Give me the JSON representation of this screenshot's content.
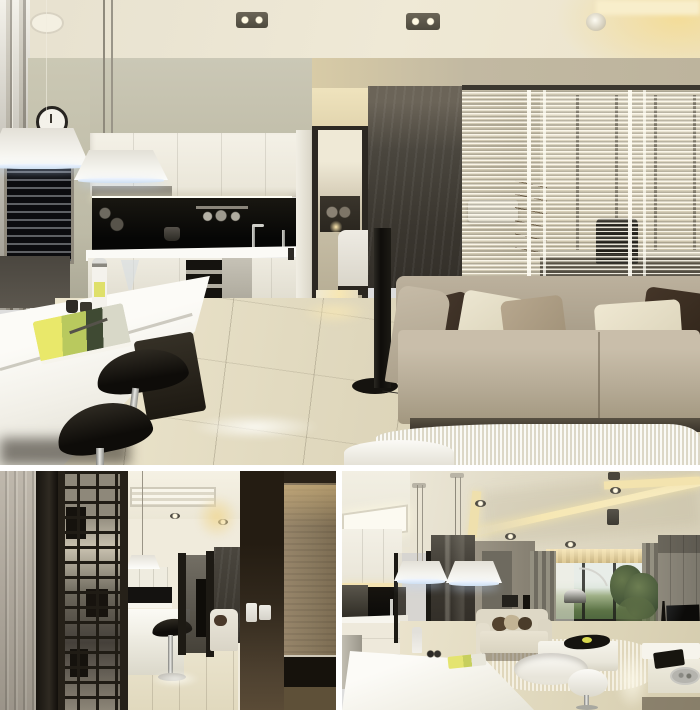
{
  "collage": {
    "title": "Modern apartment interior photo collage",
    "layout": "one large photo on top, two smaller photos below separated by white gutters",
    "photos": [
      {
        "id": "kitchen-living",
        "description": "Open-plan kitchen and living area: white island bar with black saddle stools, bottle, glass, cups and a magazine on the counter; white cabinets over a black backsplash with sink and chrome faucets; wall clock; two white pendant lamps; doorway to a bedroom; dark stone column; black tower speaker; greige fabric sofa with brown, cream and taupe cushions; white shag rug; glass partition with venetian blinds revealing a home office with black chair and dry branches; glossy beige tile floor."
      },
      {
        "id": "hallway-screen",
        "description": "Entry view: light wood plank wall, dark metal lattice screen looking through to the white island table with bar stools and black backsplash, dark brown sliding panel with white light switches, and a warm wood cabinet with a black shelf niche."
      },
      {
        "id": "living-room-wide",
        "description": "Wide living room view: white kitchen island with pendant cone lamps, cream sofa with brown pillows, chrome arc floor lamp, gray curtains and lit valance around a window with green trees, potted plant, gray media wall with flat TV, white low cabinet with tablet and chrome tray, white oval tables, cove-lit tray ceiling with recessed spots."
      }
    ]
  },
  "palette": {
    "gap-white": "#ffffff",
    "ceiling-cream": "#eae4d2",
    "ceiling-warm": "#f3e1ae",
    "wall-sage": "#c6c3af",
    "wall-tan": "#c2b9a2",
    "cabinet-white": "#f2efe5",
    "backsplash-black": "#0d0c0a",
    "counter-white": "#fbfaf6",
    "island-white": "#f8f7f2",
    "floor-beige": "#ded7c0",
    "window-dark": "#26272a",
    "stool-black": "#16130e",
    "chrome": "#b9bab6",
    "stone-dark": "#45413a",
    "office-base": "#ded6bf",
    "chair-black": "#201e19",
    "sofa-greige": "#b5aa96",
    "pillow-brown": "#3f332a",
    "pillow-cream": "#e8e2cd",
    "pillow-greige": "#b0a08a",
    "rug-white": "#edeadb",
    "speaker-black": "#17140f",
    "wood-panel": "#aba295",
    "door-brown": "#30271c",
    "switch-white": "#eceae3",
    "wood-cabinet": "#8e7c61",
    "ceiling-c": "#e3ddca",
    "cove-gold": "#f4e3ab",
    "curtain-gray": "#8c887c",
    "sky": "#e7ece7",
    "trees-green": "#5c7346",
    "plant-green": "#4a593a",
    "pot-black": "#26221c",
    "tv-black": "#0e0d0b",
    "wall-gray": "#918c80"
  }
}
